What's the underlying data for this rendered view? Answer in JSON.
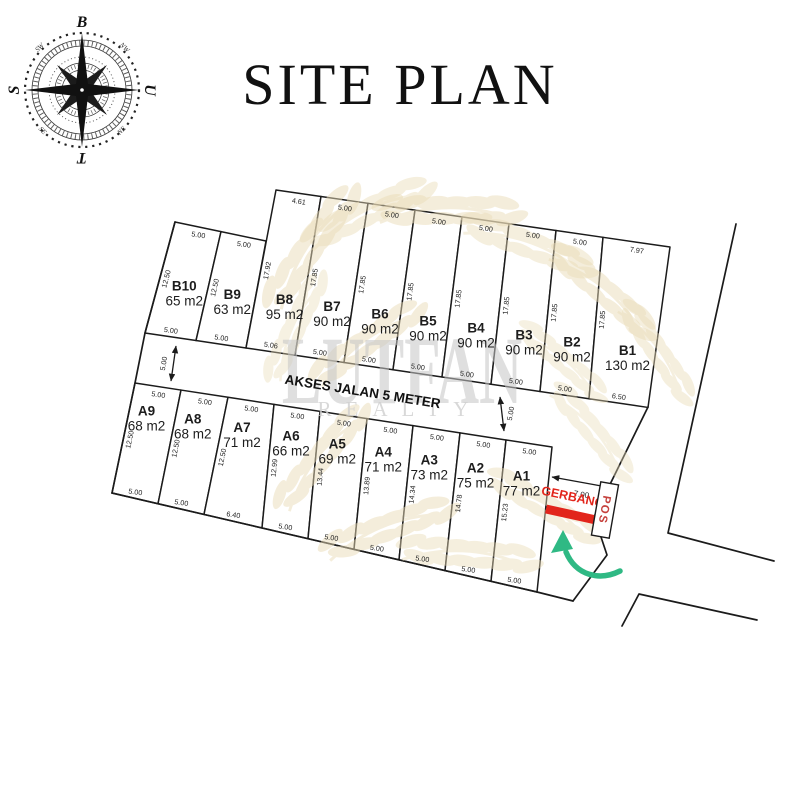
{
  "title": "SITE PLAN",
  "compass": {
    "top": "B",
    "right": "U",
    "bottom": "T",
    "left": "S",
    "diagonals": {
      "top_left": "SW",
      "top_right": "NW",
      "bottom_left": "SE",
      "bottom_right": "NE"
    }
  },
  "watermark": {
    "brand_top": "LUTFAN",
    "brand_bottom": "REALTY"
  },
  "road": {
    "label": "AKSES JALAN 5 METER",
    "left_width_dim": "5.00",
    "right_width_dim": "5.00"
  },
  "entrance": {
    "width_dim": "7.00",
    "gate_label": "GERBANG",
    "post_label": "POS"
  },
  "colors": {
    "line": "#1b1b1b",
    "gate_red": "#e2251b",
    "arrow_green": "#2fb984",
    "leaf_gold": "#ebddb8",
    "watermark_gray": "#c6c6c6"
  },
  "lots": [
    {
      "id": "B10",
      "area": "65 m2",
      "front_dim": "5.00",
      "side_dim": "12.50",
      "back_dim": "5.00"
    },
    {
      "id": "B9",
      "area": "63 m2",
      "front_dim": "5.00",
      "side_dim": "12.50",
      "back_dim": "5.00"
    },
    {
      "id": "B8",
      "area": "95 m2",
      "front_dim": "4.61",
      "side_dim": "17.92",
      "back_dim": "5.06"
    },
    {
      "id": "B7",
      "area": "90 m2",
      "front_dim": "5.00",
      "side_dim": "17.85",
      "back_dim": "5.00"
    },
    {
      "id": "B6",
      "area": "90 m2",
      "front_dim": "5.00",
      "side_dim": "17.85",
      "back_dim": "5.00"
    },
    {
      "id": "B5",
      "area": "90 m2",
      "front_dim": "5.00",
      "side_dim": "17.85",
      "back_dim": "5.00"
    },
    {
      "id": "B4",
      "area": "90 m2",
      "front_dim": "5.00",
      "side_dim": "17.85",
      "back_dim": "5.00"
    },
    {
      "id": "B3",
      "area": "90 m2",
      "front_dim": "5.00",
      "side_dim": "17.85",
      "back_dim": "5.00"
    },
    {
      "id": "B2",
      "area": "90 m2",
      "front_dim": "5.00",
      "side_dim": "17.85",
      "back_dim": "5.00"
    },
    {
      "id": "B1",
      "area": "130 m2",
      "front_dim": "7.97",
      "side_dim": "17.85",
      "back_dim": "6.50"
    },
    {
      "id": "A9",
      "area": "68 m2",
      "front_dim": "5.00",
      "side_dim": "12.50",
      "back_dim": "5.00"
    },
    {
      "id": "A8",
      "area": "68 m2",
      "front_dim": "5.00",
      "side_dim": "12.50",
      "back_dim": "5.00"
    },
    {
      "id": "A7",
      "area": "71 m2",
      "front_dim": "5.00",
      "side_dim": "12.50",
      "back_dim": "6.40"
    },
    {
      "id": "A6",
      "area": "66 m2",
      "front_dim": "5.00",
      "side_dim": "12.99",
      "back_dim": "5.00"
    },
    {
      "id": "A5",
      "area": "69 m2",
      "front_dim": "5.00",
      "side_dim": "13.44",
      "back_dim": "5.00"
    },
    {
      "id": "A4",
      "area": "71 m2",
      "front_dim": "5.00",
      "side_dim": "13.89",
      "back_dim": "5.00"
    },
    {
      "id": "A3",
      "area": "73 m2",
      "front_dim": "5.00",
      "side_dim": "14.34",
      "back_dim": "5.00"
    },
    {
      "id": "A2",
      "area": "75 m2",
      "front_dim": "5.00",
      "side_dim": "14.78",
      "back_dim": "5.00"
    },
    {
      "id": "A1",
      "area": "77 m2",
      "front_dim": "5.00",
      "side_dim": "15.23",
      "back_dim": "5.00"
    }
  ]
}
